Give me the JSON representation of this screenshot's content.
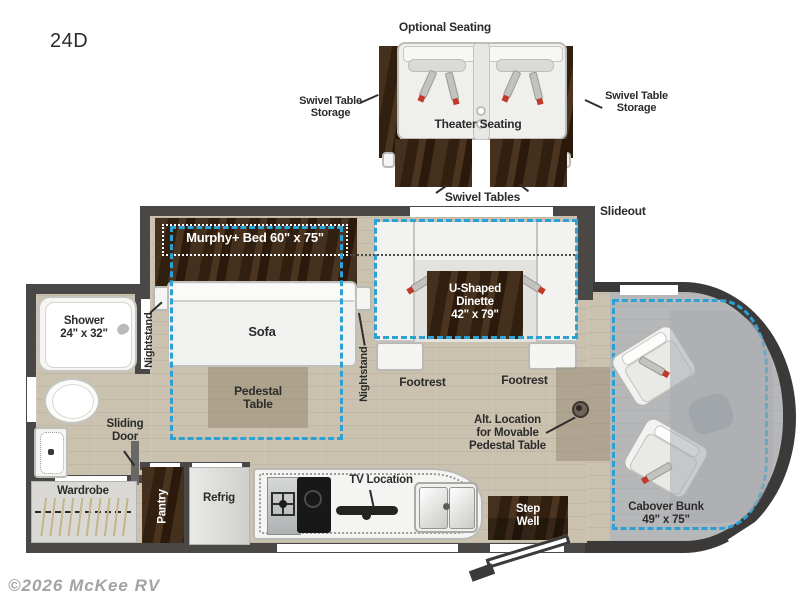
{
  "model": "24D",
  "watermark": "©2026 McKee RV",
  "colors": {
    "accent_dash": "#2da0d4",
    "wall": "#4a4846",
    "wood_dark": "#3a2715",
    "floor_wood": "#cbc1af",
    "floor_cab": "#b5b7b9",
    "seatbelt_red": "#c0392b"
  },
  "optional_seating": {
    "title": "Optional Seating",
    "left_storage": "Swivel Table\nStorage",
    "theater": "Theater Seating",
    "right_storage": "Swivel Table\nStorage",
    "tables": "Swivel Tables"
  },
  "floorplan": {
    "slideout": "Slideout",
    "murphy_bed": "Murphy+ Bed 60\" x 75\"",
    "sofa": "Sofa",
    "nightstand_left": "Nightstand",
    "nightstand_right": "Nightstand",
    "dinette": "U-Shaped\nDinette\n42\" x 79\"",
    "footrest_left": "Footrest",
    "footrest_right": "Footrest",
    "pedestal_table": "Pedestal\nTable",
    "shower": "Shower\n24\" x 32\"",
    "sliding_door": "Sliding\nDoor",
    "wardrobe": "Wardrobe",
    "pantry": "Pantry",
    "refrig": "Refrig",
    "tv_location": "TV Location",
    "step_well": "Step\nWell",
    "alt_pedestal": "Alt. Location\nfor Movable\nPedestal Table",
    "cabover_bunk": "Cabover Bunk\n49\" x 75\""
  }
}
